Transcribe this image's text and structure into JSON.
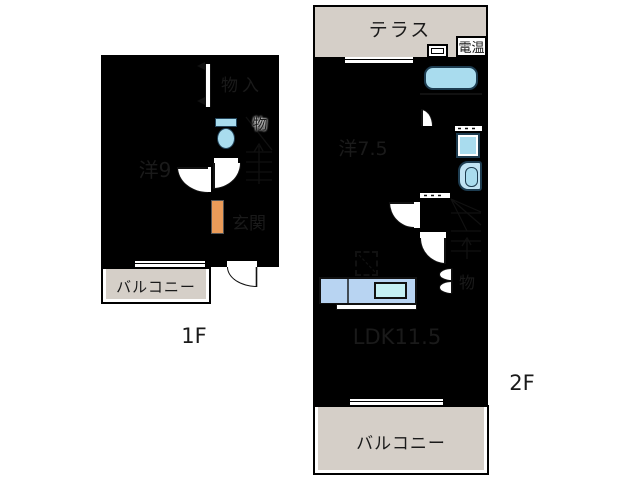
{
  "title": "apartment-floor-plan",
  "plan_1f": {
    "floor_label": "1F",
    "room_western9": "洋9",
    "room_storage_in": "物入",
    "room_stair_storage": "物",
    "room_entrance": "玄関",
    "room_balcony": "バルコニー"
  },
  "plan_2f": {
    "floor_label": "2F",
    "terrace": "テラス",
    "water_heater": "電温",
    "room_western75": "洋7.5",
    "room_ldk": "LDK11.5",
    "room_storage": "物",
    "room_balcony": "バルコニー"
  },
  "fixtures": [
    "toilet",
    "bathtub",
    "washing-machine",
    "kitchen-counter",
    "kitchen-sink",
    "refrigerator-space",
    "stairs",
    "door-swing",
    "window",
    "shoe-cabinet",
    "folding-door"
  ],
  "colors": {
    "wall": "#000000",
    "room_peach": "#F3CDA9",
    "storage_orange": "#EA9B59",
    "terrace_gray": "#D5CFC8",
    "entrance_gray": "#D3D7DA",
    "toilet_room_blue": "#D4EBF9",
    "bath_blue": "#BBE0F2",
    "washroom_blue": "#CDE7F8",
    "fixture_blue": "#A9DCEE",
    "counter_blue": "#B8D4F2",
    "sink_cyan": "#C5EFF3"
  }
}
